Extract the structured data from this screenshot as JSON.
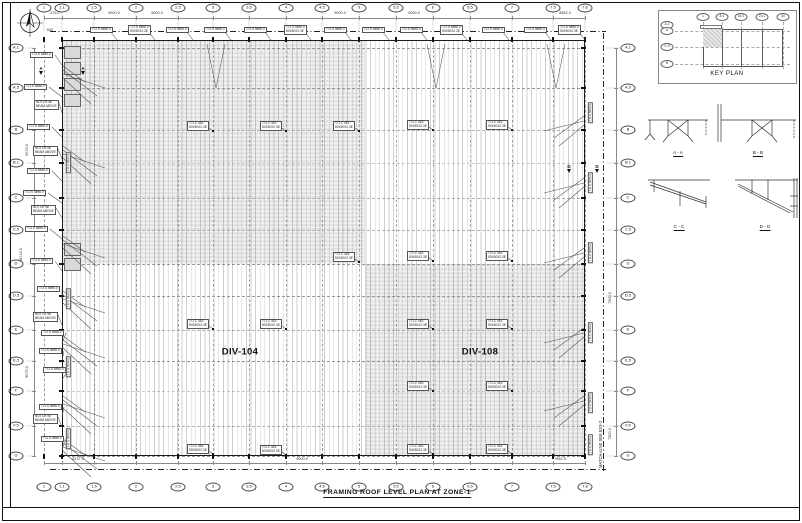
{
  "title": "FRAMING ROOF LEVEL PLAN AT ZONE-1",
  "matchline": "MATCH-LINE SEE E03-2",
  "zones": [
    {
      "label": "DIV-104",
      "x": 240,
      "y": 352
    },
    {
      "label": "DIV-108",
      "x": 480,
      "y": 352
    }
  ],
  "key_plan": {
    "label": "KEY PLAN",
    "columns": [
      "1",
      "8.1",
      "16.1",
      "23.1",
      "30"
    ],
    "rows": [
      "A.1",
      "A",
      "C.5",
      "N"
    ]
  },
  "sections": [
    {
      "label": "A - A"
    },
    {
      "label": "B - B"
    },
    {
      "label": "C - C"
    },
    {
      "label": "D - D"
    }
  ],
  "grid": {
    "columns": [
      {
        "l": "1",
        "x": 44
      },
      {
        "l": "1.1",
        "x": 62
      },
      {
        "l": "1.5",
        "x": 94
      },
      {
        "l": "2",
        "x": 136
      },
      {
        "l": "2.5",
        "x": 178
      },
      {
        "l": "3",
        "x": 213
      },
      {
        "l": "3.5",
        "x": 249
      },
      {
        "l": "4",
        "x": 286
      },
      {
        "l": "4.5",
        "x": 322
      },
      {
        "l": "5",
        "x": 359
      },
      {
        "l": "5.5",
        "x": 396
      },
      {
        "l": "6",
        "x": 433
      },
      {
        "l": "6.5",
        "x": 470
      },
      {
        "l": "7",
        "x": 512
      },
      {
        "l": "7.5",
        "x": 553
      },
      {
        "l": "7.8",
        "x": 585
      }
    ],
    "rows": [
      {
        "l": "A.1",
        "y": 48
      },
      {
        "l": "A.5",
        "y": 88
      },
      {
        "l": "B",
        "y": 130
      },
      {
        "l": "B.1",
        "y": 163
      },
      {
        "l": "C",
        "y": 198
      },
      {
        "l": "C.5",
        "y": 230
      },
      {
        "l": "D",
        "y": 264
      },
      {
        "l": "D.5",
        "y": 296
      },
      {
        "l": "E",
        "y": 330
      },
      {
        "l": "E.5",
        "y": 361
      },
      {
        "l": "F",
        "y": 391
      },
      {
        "l": "F.5",
        "y": 426
      },
      {
        "l": "G",
        "y": 456
      }
    ]
  },
  "callout_texts": {
    "elev": "T.O.S 5896.0",
    "member1": "T.O.C 463",
    "member2": "50X50X2.3E",
    "notch1": "NOTCH W/",
    "notch2": "BEAM ABOVE"
  },
  "top_callouts": {
    "y": 27,
    "xs": [
      90,
      128,
      166,
      204,
      244,
      284,
      324,
      362,
      400,
      440,
      482,
      524,
      558
    ],
    "two_line": [
      1,
      5,
      9,
      12
    ]
  },
  "interior_callouts": [
    [
      187,
      121,
      213,
      131
    ],
    [
      260,
      121,
      286,
      131
    ],
    [
      333,
      121,
      359,
      131
    ],
    [
      407,
      120,
      433,
      130
    ],
    [
      486,
      120,
      512,
      130
    ],
    [
      333,
      252,
      359,
      262
    ],
    [
      407,
      251,
      433,
      261
    ],
    [
      486,
      251,
      512,
      261
    ],
    [
      187,
      319,
      213,
      329
    ],
    [
      260,
      319,
      286,
      329
    ],
    [
      407,
      319,
      433,
      329
    ],
    [
      486,
      319,
      512,
      329
    ],
    [
      407,
      381,
      433,
      391
    ],
    [
      486,
      381,
      512,
      391
    ],
    [
      187,
      444,
      213,
      454
    ],
    [
      260,
      445,
      286,
      455
    ],
    [
      407,
      444,
      433,
      454
    ],
    [
      486,
      444,
      512,
      454
    ]
  ],
  "left_boxes": [
    [
      30,
      52,
      "A"
    ],
    [
      24,
      84,
      "A"
    ],
    [
      34,
      100,
      "B"
    ],
    [
      27,
      124,
      "A"
    ],
    [
      33,
      146,
      "B"
    ],
    [
      27,
      168,
      "A"
    ],
    [
      23,
      190,
      "A"
    ],
    [
      31,
      205,
      "B"
    ],
    [
      25,
      226,
      "A"
    ],
    [
      30,
      258,
      "A"
    ],
    [
      37,
      286,
      "A"
    ],
    [
      33,
      312,
      "B"
    ],
    [
      41,
      330,
      "A"
    ],
    [
      39,
      348,
      "A"
    ],
    [
      43,
      367,
      "A"
    ],
    [
      39,
      404,
      "A"
    ],
    [
      33,
      414,
      "B"
    ],
    [
      41,
      436,
      "A"
    ]
  ],
  "rot_boxes": [
    [
      66,
      160
    ],
    [
      66,
      296
    ],
    [
      66,
      364
    ],
    [
      66,
      436
    ],
    [
      588,
      110
    ],
    [
      588,
      180
    ],
    [
      588,
      250
    ],
    [
      588,
      330
    ],
    [
      588,
      400
    ],
    [
      588,
      442
    ]
  ],
  "section_markers": [
    {
      "label": "A",
      "x": 40,
      "y": 66
    },
    {
      "label": "A",
      "x": 82,
      "y": 66
    },
    {
      "label": "D",
      "x": 568,
      "y": 164
    },
    {
      "label": "D",
      "x": 596,
      "y": 164
    }
  ],
  "dims": {
    "top": [
      [
        "375.0",
        55
      ],
      [
        "9000.0",
        114
      ],
      [
        "9000.0",
        157
      ],
      [
        "9000.0",
        340
      ],
      [
        "9000.0",
        414
      ],
      [
        "8362.0",
        565
      ]
    ],
    "bottom": [
      [
        "8137.5",
        78
      ],
      [
        "9000.0",
        302
      ],
      [
        "7962.5",
        560
      ]
    ],
    "left": [
      [
        "9075.0",
        27,
        150
      ],
      [
        "48742.0",
        21,
        255
      ],
      [
        "9075.0",
        27,
        372
      ]
    ],
    "right": [
      [
        "7900.0",
        610,
        298
      ],
      [
        "7900.0",
        610,
        434
      ]
    ],
    "extra": [
      [
        "600",
        50,
        30
      ]
    ]
  },
  "colors": {
    "shade": "#e4e4e4",
    "linework": "#555",
    "heavy": "#111"
  }
}
